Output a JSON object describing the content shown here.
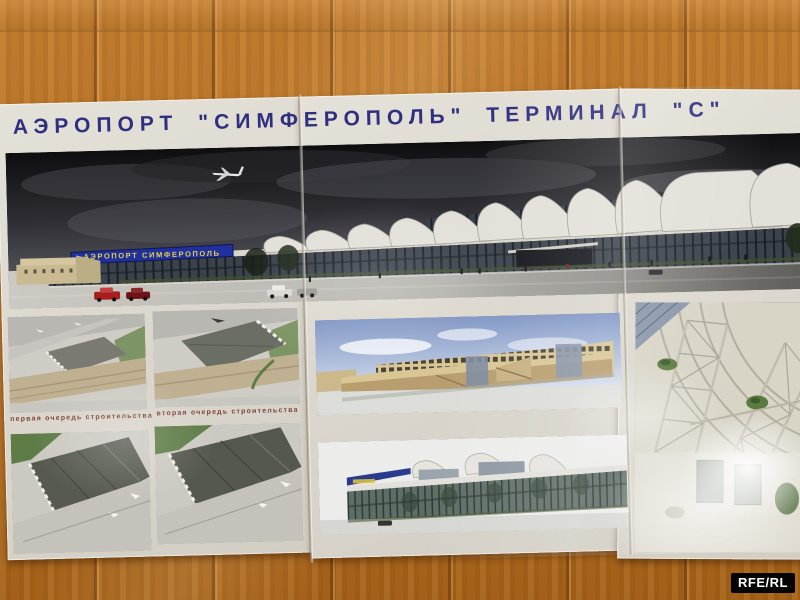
{
  "photo": {
    "watermark": "RFE/RL"
  },
  "poster": {
    "title": "АЭРОПОРТ \"СИМФЕРОПОЛЬ\" ТЕРМИНАЛ \"С\"",
    "main_rendering": {
      "sign": "АЭРОПОРТ СИМФЕРОПОЛЬ"
    },
    "phase_captions": [
      "первая очередь строительства",
      "вторая очередь строительства"
    ]
  },
  "colors": {
    "wood_wall": "#b3701f",
    "board_surface": "#dcd8cf",
    "title_text": "#2f2f80",
    "terminal_sign_bg": "#20309e",
    "terminal_sign_text": "#e6d044",
    "night_sky": "#1a1a1e",
    "roof_shells": "#e2e0d8",
    "caption_text": "#7d4434",
    "watermark_bg": "#040404",
    "watermark_text": "#ffffff"
  }
}
